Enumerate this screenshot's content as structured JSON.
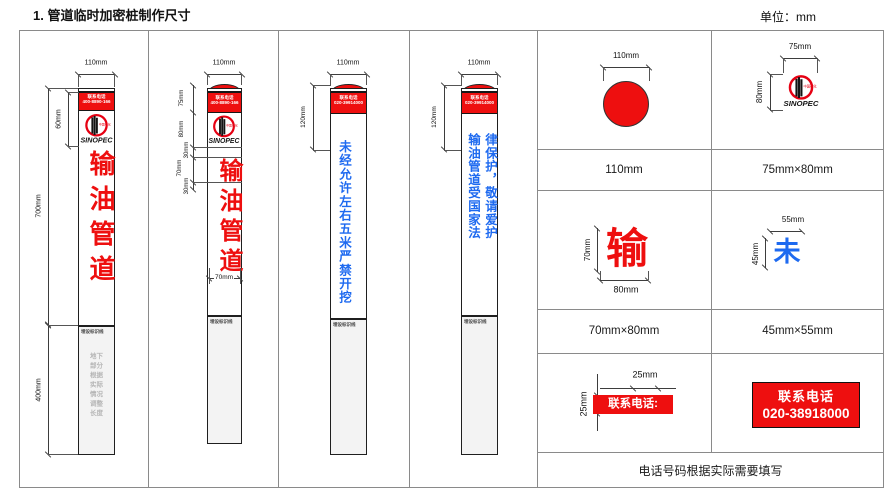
{
  "page": {
    "title": "1. 管道临时加密桩制作尺寸",
    "unit_label": "单位：mm"
  },
  "logo": {
    "wordmark": "SINOPEC",
    "cn": "中国石化"
  },
  "posts": [
    {
      "top_width": "110mm",
      "cap_line1": "联系电话",
      "cap_line2": "400-8890-166",
      "body_text": "输油管道",
      "dim_cap": "60mm",
      "dim_above": "700mm",
      "dim_below": "400mm",
      "ground_label": "埋设标识线",
      "underground_note": "地下部分根据实际情况调整长度"
    },
    {
      "top_width": "110mm",
      "cap_line1": "联系电话",
      "cap_line2": "400-8890-166",
      "body_text": "输油管道",
      "dim_cap": "75mm",
      "dim_logo": "80mm",
      "dim_gap1": "30mm",
      "dim_char": "70mm",
      "dim_gap2": "30mm",
      "dim_char_width": "70mm",
      "ground_label": "埋设标识线"
    },
    {
      "top_width": "110mm",
      "cap_line1": "联系电话",
      "cap_line2": "020-39914000",
      "body_text": "未经允许左右五米严禁开挖",
      "dim_cap_area": "120mm",
      "ground_label": "埋设标识线"
    },
    {
      "top_width": "110mm",
      "cap_line1": "联系电话",
      "cap_line2": "020-39914000",
      "col_left": "输油管道受国家法",
      "col_right": "律保护，敬请爱护",
      "dim_cap_area": "120mm",
      "ground_label": "埋设标识线"
    }
  ],
  "details": {
    "circle": {
      "dim_top": "110mm",
      "caption": "110mm"
    },
    "logo_cell": {
      "dim_top": "75mm",
      "dim_left": "80mm",
      "caption": "75mm×80mm"
    },
    "char_shu": {
      "glyph": "输",
      "dim_left": "70mm",
      "dim_bottom": "80mm",
      "caption": "70mm×80mm"
    },
    "char_wei": {
      "glyph": "未",
      "dim_top": "55mm",
      "dim_left": "45mm",
      "caption": "45mm×55mm"
    },
    "band_small": {
      "label": "联系电话:",
      "dim_top": "25mm",
      "dim_left": "25mm"
    },
    "band_large": {
      "line1": "联系电话",
      "line2": "020-38918000"
    },
    "footer_note": "电话号码根据实际需要填写"
  },
  "colors": {
    "marker_red": "#ee0f0f",
    "text_blue": "#1e6af0",
    "grid_gray": "#8a8a8a"
  }
}
